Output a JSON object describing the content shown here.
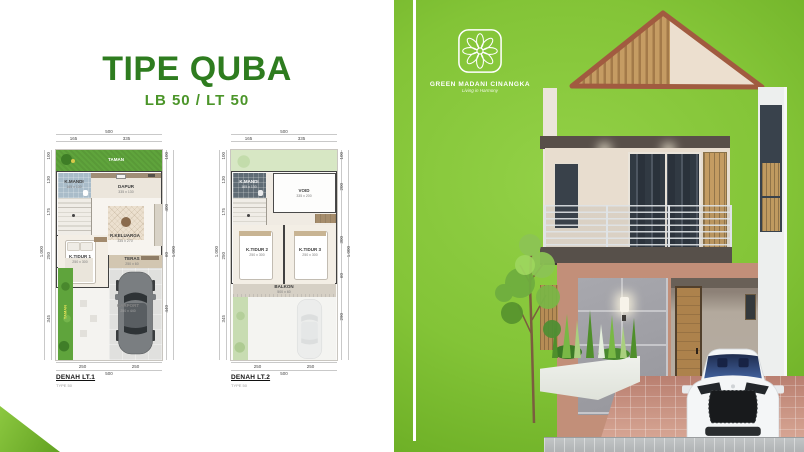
{
  "header": {
    "title": "TIPE QUBA",
    "subtitle": "LB 50 / LT 50"
  },
  "logo": {
    "name": "GREEN MADANI CINANGKA",
    "tagline": "Living in Harmony",
    "icon": "flower-mandala"
  },
  "colors": {
    "title_green": "#2e7c1f",
    "subtitle_green": "#4b9529",
    "background_green_light": "#93d147",
    "background_green_dark": "#61a01d",
    "roof_brown": "#a15b40",
    "wood": "#c59c63",
    "wall_cream": "#e8ddcf",
    "stone_gray": "#9fa0a6",
    "plan_garden_green": "#5fa43c"
  },
  "plans": [
    {
      "caption": "DENAH LT.1",
      "subcaption": "TYPE 50",
      "dims": {
        "top_total": "500",
        "top": [
          "165",
          "335"
        ],
        "left": [
          "100",
          "130",
          "175",
          "250",
          "345"
        ],
        "left_total": "1.000",
        "right": [
          "100",
          "400",
          "60",
          "440"
        ],
        "right_total": "1.000",
        "bottom": [
          "250",
          "250"
        ],
        "bottom_total": "500"
      },
      "rooms": {
        "taman_top": "TAMAN",
        "kmandi": {
          "label": "K.MANDI",
          "size": "165 x 130"
        },
        "dapur": {
          "label": "DAPUR",
          "size": "335 x 130"
        },
        "rkeluarga": {
          "label": "R.KELUARGA",
          "size": "335 x 270"
        },
        "ktidur1": {
          "label": "K.TIDUR 1",
          "size": "250 x 300"
        },
        "teras": {
          "label": "TERAS",
          "size": "250 x 60"
        },
        "carport": {
          "label": "CARPORT",
          "size": "250 x 440"
        },
        "taman_side": "TAMAN"
      }
    },
    {
      "caption": "DENAH LT.2",
      "subcaption": "TYPE 50",
      "dims": {
        "top_total": "500",
        "top": [
          "165",
          "335"
        ],
        "left": [
          "100",
          "130",
          "175",
          "250",
          "345"
        ],
        "left_total": "1.000",
        "right": [
          "100",
          "200",
          "300",
          "60",
          "290"
        ],
        "right_total": "1.000",
        "bottom": [
          "250",
          "250"
        ],
        "bottom_total": "500"
      },
      "rooms": {
        "kmandi": {
          "label": "K.MANDI",
          "size": "165 x 130"
        },
        "void": {
          "label": "VOID",
          "size": "335 x 200"
        },
        "ktidur2": {
          "label": "K.TIDUR 2",
          "size": "250 x 300"
        },
        "ktidur3": {
          "label": "K.TIDUR 3",
          "size": "250 x 300"
        },
        "balkon": {
          "label": "BALKON",
          "size": "500 x 60"
        }
      }
    }
  ]
}
